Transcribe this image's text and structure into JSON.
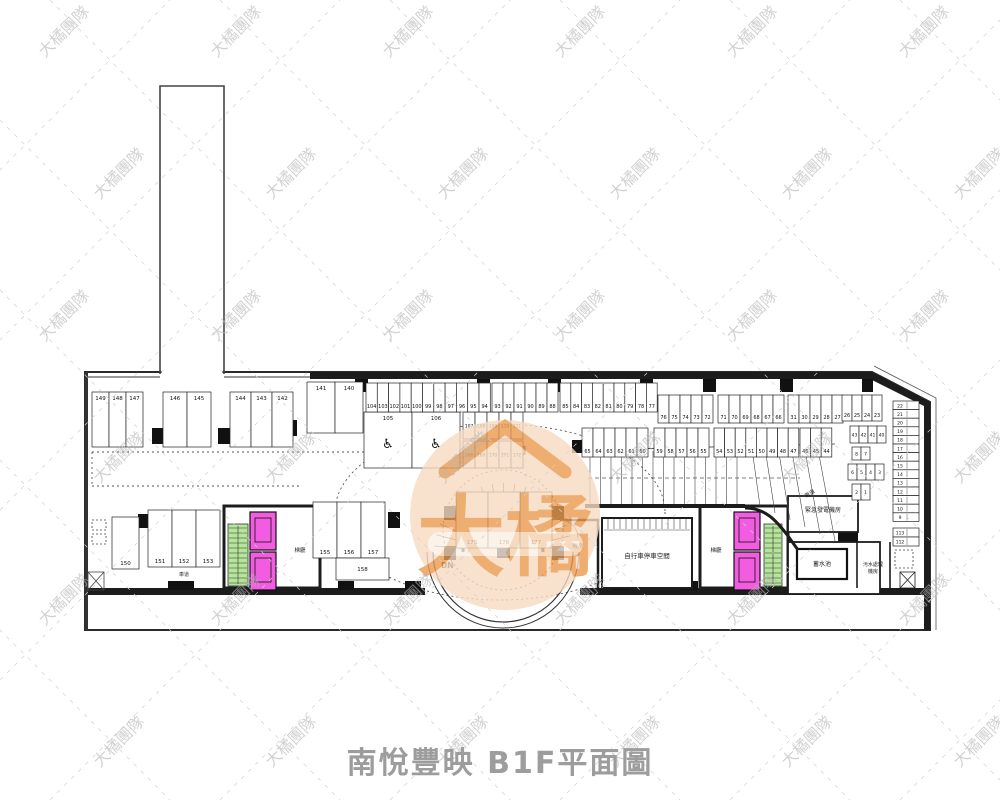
{
  "title": {
    "text": "南悅豐映 B1F平面圖",
    "color": "#9d9d9d"
  },
  "watermark": {
    "text": "大橘團隊",
    "text_color": "#b5b5b5",
    "line_color": "#d0d0d0"
  },
  "center_watermark": {
    "text": "大橘",
    "circle_color": "#f7dcc2",
    "text_color": "#eb9a4e"
  },
  "labels": {
    "parking_area": "停車空間",
    "down": "DN",
    "ramp": "車道",
    "lane": "車道",
    "lobby_left": "梯廳",
    "lobby_right": "梯廳",
    "machine_room": "機房",
    "bike_room": "自行車停車空間",
    "generator_room": "緊急發電機房",
    "water_tank": "蓄水池",
    "sewage_line1": "污水處理",
    "sewage_line2": "機房"
  },
  "colors": {
    "elevator": "#f25ce0",
    "stair": "#b5e49b",
    "wall": "#1c1c1c"
  },
  "stalls": {
    "car_a": [
      "149",
      "148",
      "147"
    ],
    "car_b": [
      "146",
      "145"
    ],
    "car_c": [
      "144",
      "143",
      "142"
    ],
    "car_wide": [
      "141",
      "140"
    ],
    "hc": [
      "105",
      "106"
    ],
    "hs_top": [
      "107",
      "108",
      "109",
      "110",
      "111"
    ],
    "hs_bot": [
      "168",
      "169",
      "170",
      "171",
      "172"
    ],
    "b1a": [
      "104",
      "103",
      "102",
      "101",
      "100",
      "99",
      "98",
      "97",
      "96",
      "95",
      "94"
    ],
    "b1b": [
      "93",
      "92",
      "91",
      "90",
      "89",
      "88"
    ],
    "b1c": [
      "85",
      "84",
      "83",
      "82",
      "81",
      "80",
      "79",
      "78",
      "77"
    ],
    "b1d": [
      "76",
      "75",
      "74",
      "73",
      "72"
    ],
    "b1e": [
      "71",
      "70",
      "69",
      "68",
      "67",
      "66"
    ],
    "b1f": [
      "31",
      "30",
      "29",
      "28",
      "27"
    ],
    "b1g": [
      "26",
      "25",
      "24",
      "23"
    ],
    "b2a": [
      "65",
      "64",
      "63",
      "62",
      "61",
      "60"
    ],
    "b2b": [
      "59",
      "58",
      "57",
      "56",
      "55"
    ],
    "b2c": [
      "54",
      "53",
      "52",
      "51",
      "50",
      "49",
      "48",
      "47"
    ],
    "b2d": [
      "46",
      "45",
      "44"
    ],
    "grid_a": [
      "43",
      "42",
      "41",
      "40"
    ],
    "small_r": [
      "8",
      "7"
    ],
    "grid_b": [
      "6",
      "5",
      "4",
      "3"
    ],
    "grid_c": [
      "2",
      "1"
    ],
    "col_r": [
      "22",
      "21",
      "20",
      "19",
      "18",
      "17",
      "16",
      "15",
      "14",
      "13",
      "12",
      "11",
      "10",
      "9"
    ],
    "col_r2": [
      "113",
      "112"
    ],
    "bl_tall": [
      "150"
    ],
    "bl3": [
      "151",
      "152",
      "153"
    ],
    "mid3": [
      "155",
      "156",
      "157"
    ],
    "midH": [
      "158"
    ],
    "island": [
      "175",
      "176",
      "177"
    ]
  }
}
